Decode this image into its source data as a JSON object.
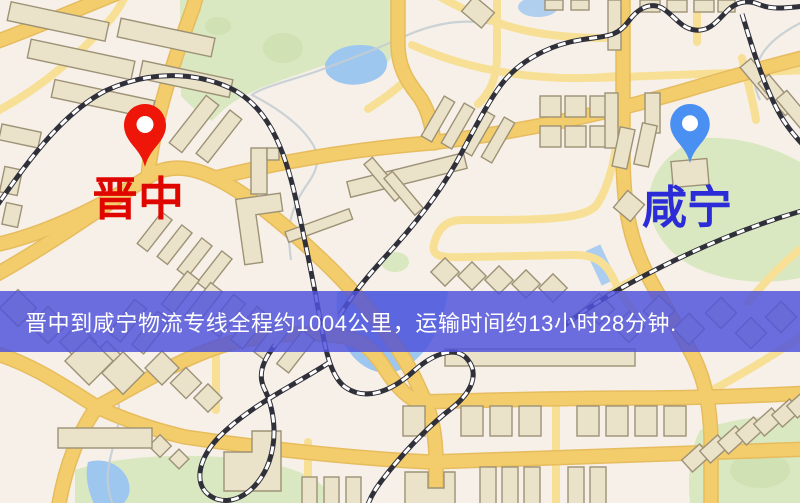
{
  "banner": {
    "text": "晋中到咸宁物流专线全程约1004公里，运输时间约13小时28分钟.",
    "bg_color": "rgba(80,84,219,0.84)",
    "text_color": "#ffffff"
  },
  "markers": {
    "origin": {
      "label": "晋中",
      "label_color": "#e00600",
      "pin_color": "#ee1509",
      "pin_inner_color": "#ffffff"
    },
    "destination": {
      "label": "咸宁",
      "label_color": "#2b2bd8",
      "pin_color": "#4a90f2",
      "pin_inner_color": "#ffffff"
    }
  },
  "map_colors": {
    "land": "#f7f0e8",
    "park": "#d9e8c1",
    "park_dark": "#c9dda8",
    "water": "#9ec7f0",
    "stream": "#c2ccd2",
    "road_major": "#f3cd6b",
    "road_casing": "#e6bc5e",
    "road_minor": "#f7e096",
    "building_fill": "#ebe2ca",
    "building_stroke": "#9d9276",
    "railway": "#30303a",
    "railway_dash": "#ffffff"
  }
}
